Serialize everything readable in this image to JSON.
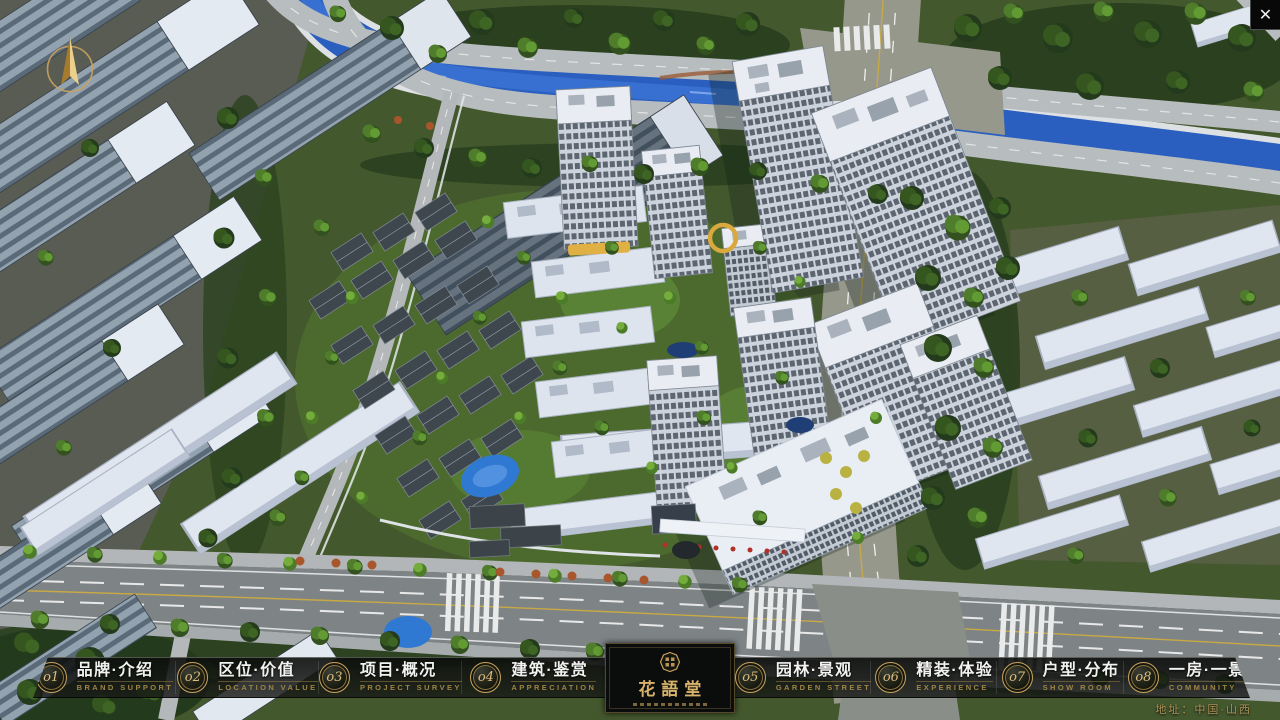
{
  "window": {
    "close_glyph": "✕"
  },
  "icons": {
    "close-icon": "✕",
    "compass-icon": "gold-north-needle-in-ring",
    "logo-seal-icon": "octagon-seal"
  },
  "logo": {
    "title": "花語堂"
  },
  "nav": {
    "items": [
      {
        "num": "o1",
        "label": "品牌·介绍",
        "sub": "BRAND SUPPORT"
      },
      {
        "num": "o2",
        "label": "区位·价值",
        "sub": "LOCATION VALUE"
      },
      {
        "num": "o3",
        "label": "项目·概况",
        "sub": "PROJECT SURVEY"
      },
      {
        "num": "o4",
        "label": "建筑·鉴赏",
        "sub": "APPRECIATION"
      },
      {
        "num": "o5",
        "label": "园林·景观",
        "sub": "GARDEN STREET"
      },
      {
        "num": "o6",
        "label": "精装·体验",
        "sub": "EXPERIENCE"
      },
      {
        "num": "o7",
        "label": "户型·分布",
        "sub": "SHOW ROOM"
      },
      {
        "num": "o8",
        "label": "一房·一景",
        "sub": "COMMUNITY"
      }
    ]
  },
  "footer": {
    "address": "地址：中国·山西"
  },
  "colors": {
    "accent_gold": "#c9a35c",
    "nav_text_white": "#f2f3f0",
    "nav_text_gold": "#9d8447",
    "nav_bg": "#0c0e0c",
    "river_blue": "#2a5fc0",
    "road_gray": "#8e9395",
    "ground_green": "#44582e"
  }
}
